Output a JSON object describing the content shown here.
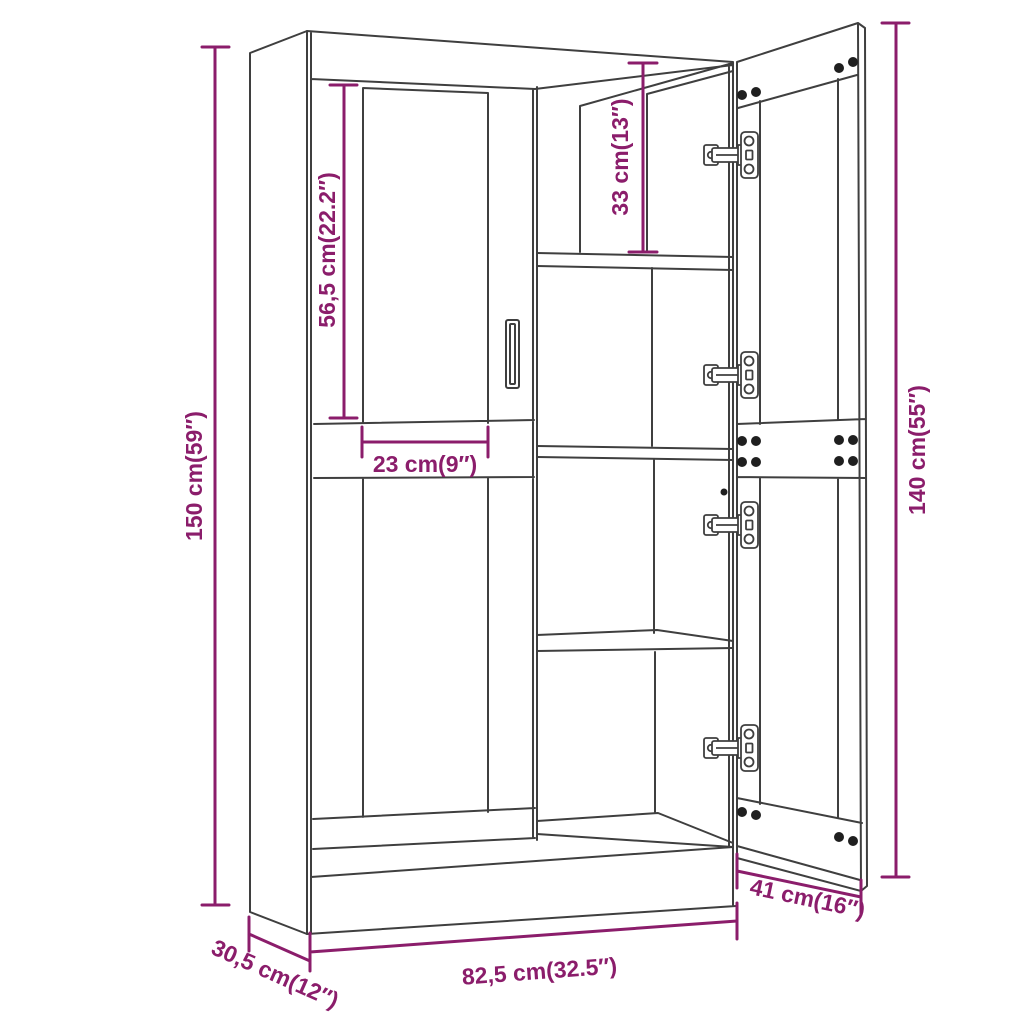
{
  "diagram": {
    "background_color": "#ffffff",
    "line_color": "#3f3f3f",
    "accent_color": "#8b1d6b",
    "dimensions": [
      {
        "id": "overall-height",
        "label": "150 cm(59″)",
        "value_cm": "150",
        "value_inch": "59"
      },
      {
        "id": "upper-glass-height",
        "label": "56,5 cm(22.2″)",
        "value_cm": "56,5",
        "value_inch": "22.2"
      },
      {
        "id": "top-compartment-height",
        "label": "33 cm(13″)",
        "value_cm": "33",
        "value_inch": "13"
      },
      {
        "id": "door-glass-width",
        "label": "23 cm(9″)",
        "value_cm": "23",
        "value_inch": "9"
      },
      {
        "id": "door-height",
        "label": "140 cm(55″)",
        "value_cm": "140",
        "value_inch": "55"
      },
      {
        "id": "door-width",
        "label": "41 cm(16″)",
        "value_cm": "41",
        "value_inch": "16"
      },
      {
        "id": "overall-width",
        "label": "82,5 cm(32.5″)",
        "value_cm": "82,5",
        "value_inch": "32.5"
      },
      {
        "id": "overall-depth",
        "label": "30,5 cm(12″)",
        "value_cm": "30,5",
        "value_inch": "12"
      }
    ]
  }
}
